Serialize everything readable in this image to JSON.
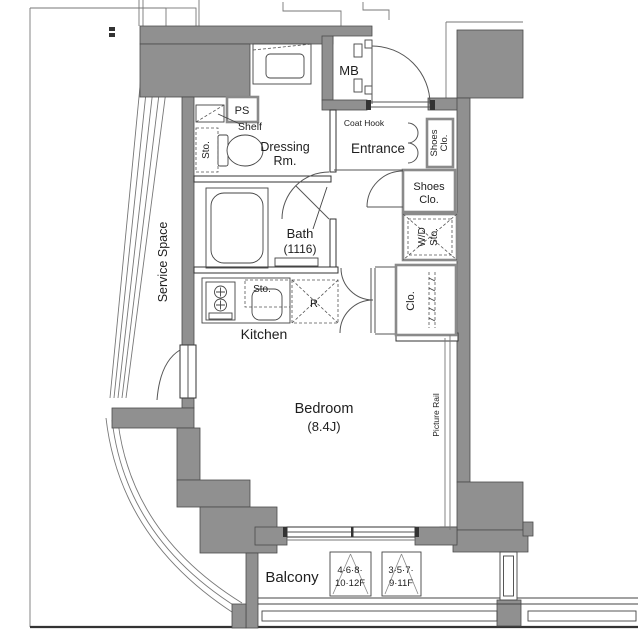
{
  "plan": {
    "rooms": {
      "service_space": "Service Space",
      "dressing_room": {
        "line1": "Dressing",
        "line2": "Rm."
      },
      "entrance": "Entrance",
      "bath": {
        "name": "Bath",
        "size": "(1116)"
      },
      "kitchen": "Kitchen",
      "bedroom": {
        "name": "Bedroom",
        "size": "(8.4J)"
      },
      "balcony": "Balcony"
    },
    "fixtures": {
      "ps": "PS",
      "shelf": "Shelf",
      "storage_dressing": "Sto.",
      "meter_box": "MB",
      "coat_hook": "Coat Hook",
      "shoes_closet_small": {
        "line1": "Shoes",
        "line2": "Clo."
      },
      "shoes_closet": {
        "line1": "Shoes",
        "line2": "Clo."
      },
      "washer_dryer_storage": {
        "line1": "W/D",
        "line2": "Sto."
      },
      "closet": "Clo.",
      "storage_kitchen": "Sto.",
      "refrigerator": "R",
      "picture_rail": "Picture Rail"
    },
    "floor_signs": [
      {
        "line1": "4·6·8·",
        "line2": "10·12F"
      },
      {
        "line1": "3·5·7·",
        "line2": "9·11F"
      }
    ],
    "colors": {
      "wall_fill": "#909090",
      "line": "#3a3a3a",
      "background": "#ffffff"
    }
  }
}
